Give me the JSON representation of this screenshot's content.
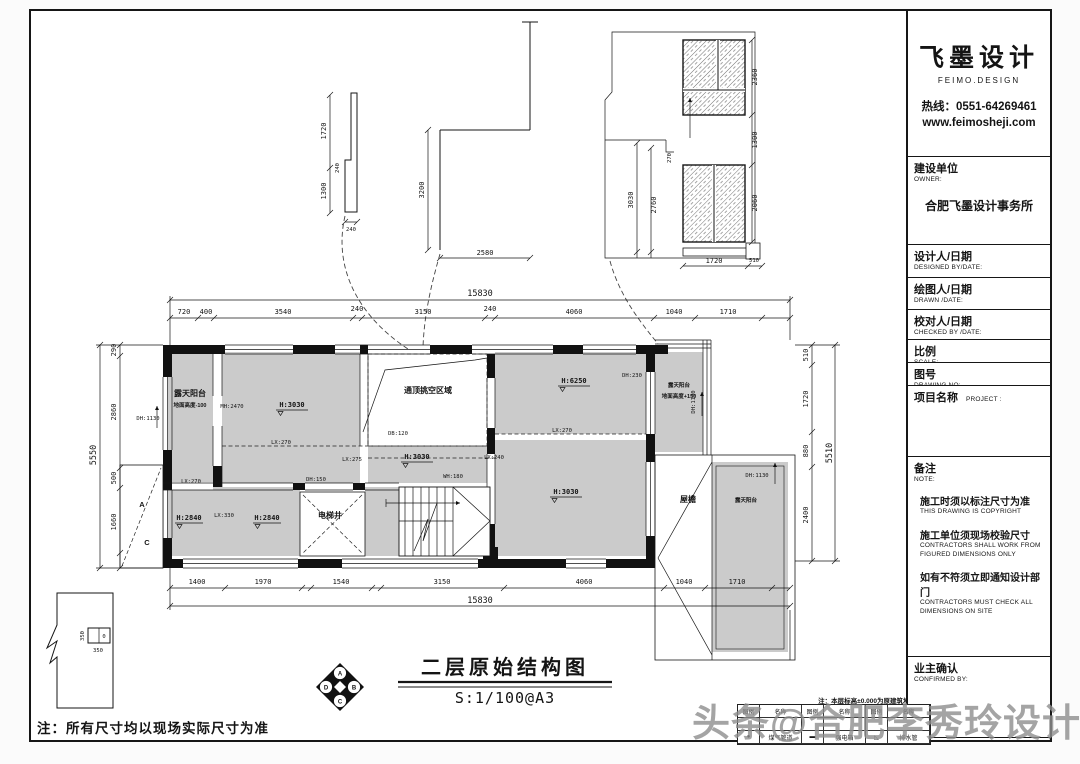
{
  "watermark": "头条@合肥李秀玲设计师",
  "sheet_note": "注：所有尺寸均以现场实际尺寸为准",
  "level_note": "注：本层标高±0.000为原建筑地面标高",
  "title_bar": {
    "title": "二层原始结构图",
    "scale": "S:1/100@A3"
  },
  "compass": {
    "n": "A",
    "e": "B",
    "s": "C",
    "w": "D"
  },
  "legend": {
    "headers": [
      "图例",
      "名称",
      "图例",
      "名称",
      "图例",
      "名称"
    ],
    "rows": [
      [
        "",
        "",
        "",
        "",
        "",
        ""
      ],
      [
        "●",
        "煤气管道",
        "▬",
        "强电箱",
        "◺",
        "排水管"
      ]
    ]
  },
  "title_block": {
    "brand": {
      "name": "飞墨设计",
      "tagline": "FEIMO.DESIGN",
      "hotline": "热线：0551-64269461",
      "website": "www.feimosheji.com"
    },
    "owner": {
      "label": "建设单位",
      "en": "OWNER:",
      "value": "合肥飞墨设计事务所"
    },
    "designed": {
      "label": "设计人/日期",
      "en": "DESIGNED BY/DATE:"
    },
    "drawn": {
      "label": "绘图人/日期",
      "en": "DRAWN /DATE:"
    },
    "checked": {
      "label": "校对人/日期",
      "en": "CHECKED BY /DATE:"
    },
    "scale": {
      "label": "比例",
      "en": "SCALE:"
    },
    "drawing_no": {
      "label": "图号",
      "en": "DRAWING NO:"
    },
    "project": {
      "label": "项目名称",
      "en": "PROJECT :"
    },
    "note": {
      "label": "备注",
      "en": "NOTE:",
      "items": [
        {
          "cn": "施工时须以标注尺寸为准",
          "en": "THIS DRAWING IS COPYRIGHT"
        },
        {
          "cn": "施工单位须现场校验尺寸",
          "en": "CONTRACTORS SHALL WORK FROM FIGURED DIMENSIONS ONLY"
        },
        {
          "cn": "如有不符须立即通知设计部门",
          "en": "CONTRACTORS MUST CHECK ALL DIMENSIONS ON SITE"
        }
      ]
    },
    "confirmed": {
      "label": "业主确认",
      "en": "CONFIRMED BY:"
    }
  },
  "plan": {
    "rooms": {
      "balcony_left": "露天阳台",
      "balcony_left_sub": "地面高度-100",
      "room_left": "H:3030",
      "void": "通顶挑空区域",
      "room_top_right": "H:6250",
      "room_center": "H:3030",
      "room_bottom_right": "H:3030",
      "room_bl_1": "H:2840",
      "room_bl_2": "H:2840",
      "elevator": "电梯井",
      "balcony_top_right": "露天阳台",
      "balcony_top_right_sub": "地面高度+150",
      "eave": "屋檐",
      "balcony_bottom_right": "露天阳台"
    },
    "tags": {
      "mh2470": "MH:2470",
      "dh1130": "DH:1130",
      "lx270": "LX:270",
      "db120": "DB:120",
      "lx275": "LX:275",
      "lx240": "LX:240",
      "wh180": "WH:180",
      "lx330": "LX:330",
      "dh150": "DH:150",
      "dh230": "DH:230"
    },
    "axes": {
      "a": "A",
      "c": "C"
    },
    "dims": {
      "top_total": "15830",
      "top": [
        "720",
        "400",
        "3540",
        "240",
        "3150",
        "240",
        "4060",
        "1040",
        "1710"
      ],
      "bottom": [
        "1400",
        "1970",
        "1540",
        "3150",
        "4060",
        "1040",
        "1710"
      ],
      "bottom_total": "15830",
      "left": [
        "290",
        "2860",
        "500",
        "1660"
      ],
      "left_total": "5550",
      "right": [
        "510",
        "1720",
        "880",
        "2400"
      ],
      "right_total": "5510"
    },
    "details": {
      "d1": {
        "v1": "1720",
        "v2": "1300",
        "w": "240",
        "b": "240"
      },
      "d2": {
        "h": "3200",
        "w": "2580"
      },
      "d3": {
        "r1": "2360",
        "r2": "1300",
        "r3": "2060",
        "l1": "3030",
        "l2": "2760",
        "l3": "270",
        "b1": "1720",
        "b2": "510"
      }
    },
    "small_detail": {
      "label": "0",
      "d1": "350",
      "d2": "350"
    }
  }
}
